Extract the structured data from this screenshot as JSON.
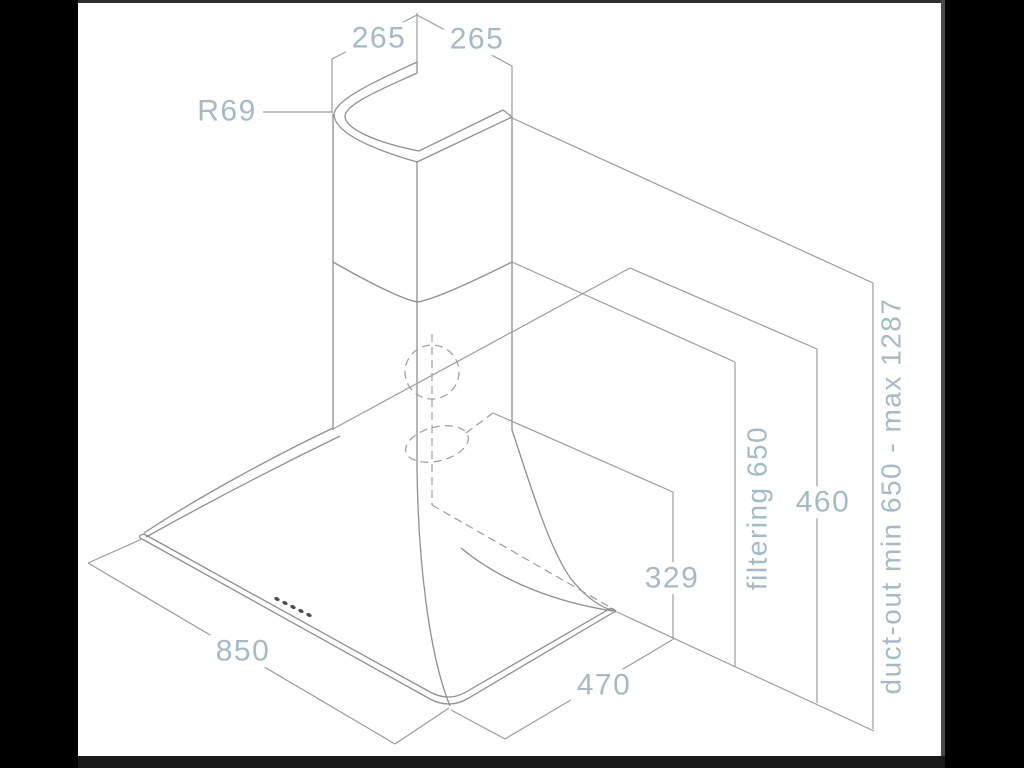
{
  "colors": {
    "canvas": "#ffffff",
    "frame": "#000000",
    "bottom_bar": "#191919",
    "top_line": "#2e2e2e",
    "edge_line": "#4a4a4a",
    "line": "#8f8f8f",
    "dimline": "#9c9c9c",
    "accent": "#a3bac9",
    "dot": "#4a4a4a"
  },
  "diagram": {
    "type": "cooker-hood dimensional drawing",
    "labels": {
      "chimney_width_left": "265",
      "chimney_depth_right": "265",
      "corner_radius": "R69",
      "filtering_height": "filtering 650",
      "lower_chimney_height": "460",
      "duct_out_height": "duct-out min 650 - max 1287",
      "duct_offset": "329",
      "body_width": "850",
      "body_depth": "470"
    }
  }
}
